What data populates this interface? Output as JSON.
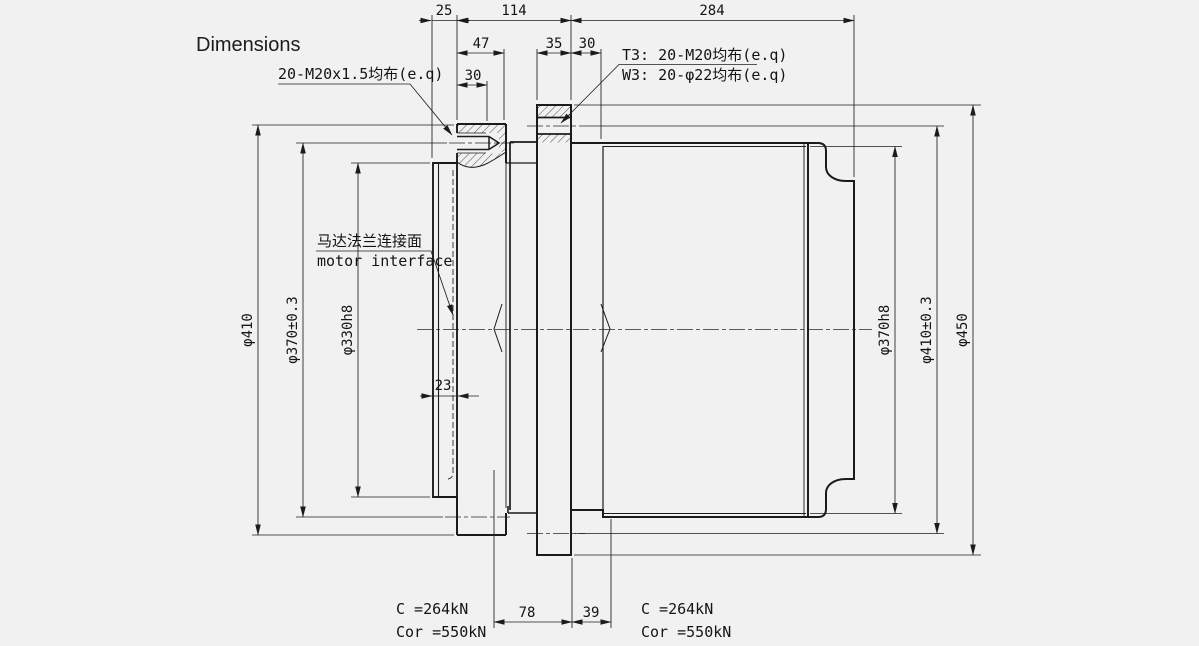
{
  "title": "Dimensions",
  "callouts": {
    "left_bolts": "20-M20x1.5均布(e.q)",
    "t3": "T3: 20-M20均布(e.q)",
    "w3": "W3: 20-φ22均布(e.q)",
    "motor_cn": "马达法兰连接面",
    "motor_en": "motor interface"
  },
  "dims": {
    "d25": "25",
    "d114": "114",
    "d284": "284",
    "d47": "47",
    "d30_depth": "30",
    "d35": "35",
    "d30_step": "30",
    "d23": "23",
    "d78": "78",
    "d39": "39",
    "dia_410_left": "φ410",
    "dia_370_left": "φ370±0.3",
    "dia_330_left": "φ330h8",
    "dia_370_right": "φ370h8",
    "dia_410_right": "φ410±0.3",
    "dia_450_right": "φ450"
  },
  "ratings": {
    "left": {
      "c": "C =264kN",
      "cor": "Cor =550kN"
    },
    "right": {
      "c": "C =264kN",
      "cor": "Cor =550kN"
    }
  },
  "colors": {
    "background": "#f1f1f2",
    "line": "#1b1b1b"
  }
}
